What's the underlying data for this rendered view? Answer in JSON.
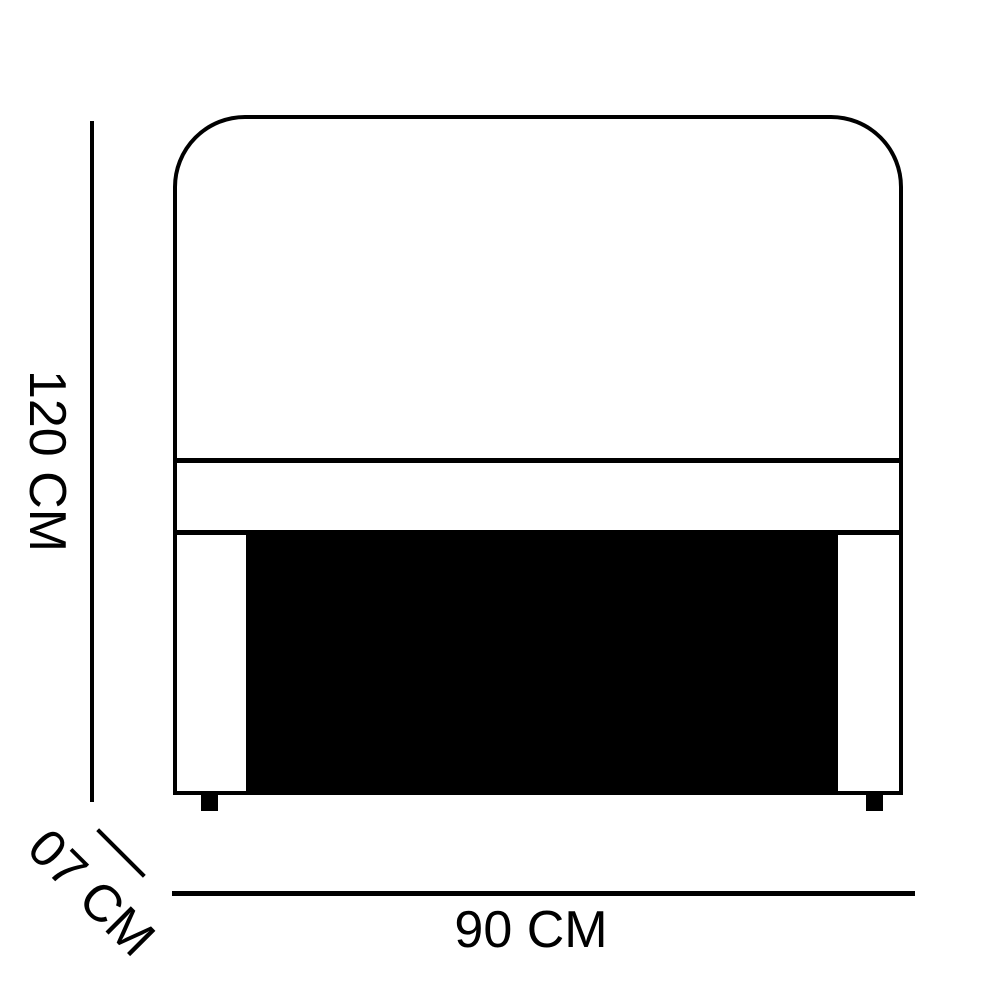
{
  "dimensions": {
    "height_label": "120 CM",
    "width_label": "90 CM",
    "depth_label": "07 CM"
  },
  "colors": {
    "line": "#000000",
    "fill_panel": "#000000",
    "background": "#ffffff",
    "text": "#000000"
  }
}
